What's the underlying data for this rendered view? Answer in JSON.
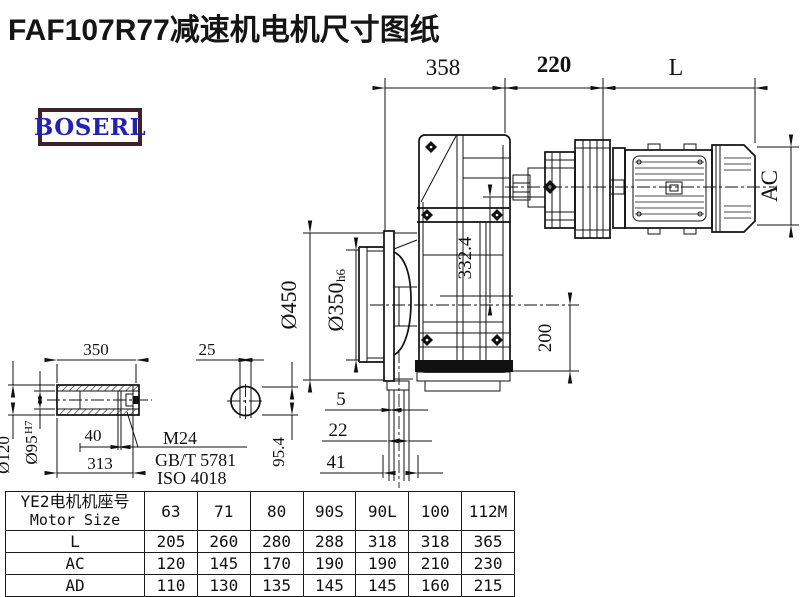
{
  "title": "FAF107R77减速机电机尺寸图纸",
  "logo": {
    "text": "BOSERL"
  },
  "drawing": {
    "top_dims": {
      "width_gearbox": "358",
      "width_adapter": "220",
      "motor_length": "L"
    },
    "flange": {
      "outer_dia": "Ø450",
      "spigot_dia": "Ø350",
      "spigot_tol": "h6"
    },
    "heights": {
      "center_height": "332.4",
      "foot_height": "200",
      "motor_height": "AC"
    },
    "shaft_steps": {
      "s1": "5",
      "s2": "22",
      "s3": "41"
    },
    "shaft_detail": {
      "length": "350",
      "keyway_width": "25",
      "outer_dia": "Ø120",
      "bore_dia": "Ø95",
      "bore_tol": "H7",
      "step": "40",
      "length2": "313",
      "across_keyway": "95.4",
      "thread": "M24",
      "standard_gb": "GB/T 5781",
      "standard_iso": "ISO 4018"
    }
  },
  "table": {
    "header_line1": "YE2电机机座号",
    "header_line2": "Motor Size",
    "columns": [
      "63",
      "71",
      "80",
      "90S",
      "90L",
      "100",
      "112M"
    ],
    "rows": [
      {
        "label": "L",
        "values": [
          "205",
          "260",
          "280",
          "288",
          "318",
          "318",
          "365"
        ]
      },
      {
        "label": "AC",
        "values": [
          "120",
          "145",
          "170",
          "190",
          "190",
          "210",
          "230"
        ]
      },
      {
        "label": "AD",
        "values": [
          "110",
          "130",
          "135",
          "145",
          "145",
          "160",
          "215"
        ]
      }
    ]
  },
  "colors": {
    "line": "#111111",
    "logo_border": "#3f2228",
    "logo_text": "#2323b0",
    "background": "#ffffff"
  }
}
